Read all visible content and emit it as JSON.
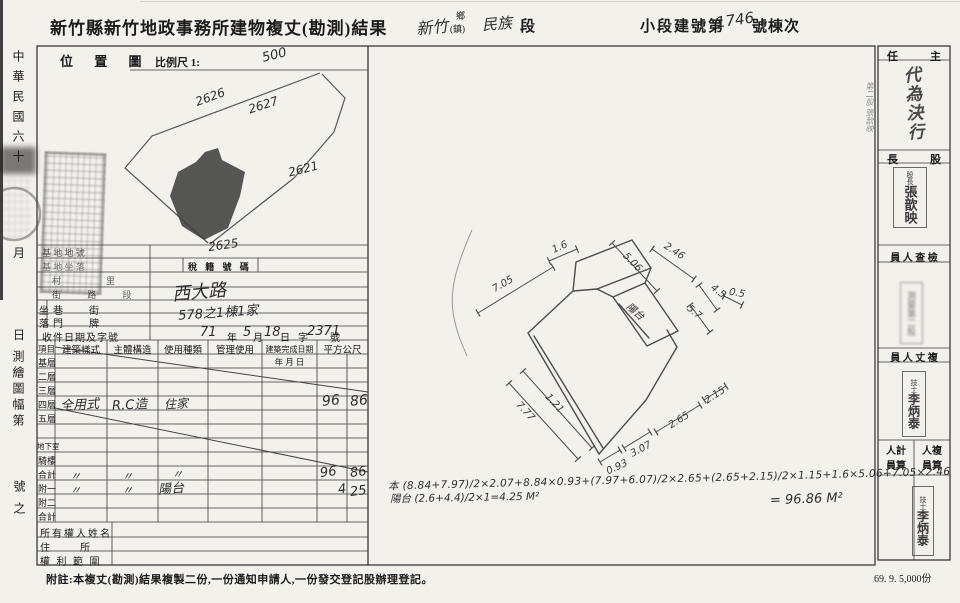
{
  "page": {
    "print_code": "69. 9. 5,000份"
  },
  "header": {
    "office_title": "新竹縣新竹地政事務所建物複丈(勘測)結果",
    "township_value": "新竹",
    "township_unit_top": "鄉",
    "township_unit_bottom": "(鎮)",
    "section_value": "民族",
    "section_unit": "段",
    "building_no_label": "小段建號第",
    "building_no_value": "1746",
    "building_no_suffix": "號棟次"
  },
  "date_strip": {
    "era": "中華民國六十",
    "month_char": "月",
    "day_char": "日",
    "map_sheet": "測繪圖幅第",
    "map_sheet_suffix": "號之"
  },
  "location_map": {
    "title": "位 置 圖",
    "scale_label": "比例尺 1:",
    "scale_value": "500",
    "parcel_2626": "2626",
    "parcel_2627": "2627",
    "parcel_2621": "2621",
    "parcel_2625": "2625"
  },
  "site_info": {
    "row_base_no": "基 地 地 號",
    "row_base_loc": "基 地 坐 落",
    "tax_no_label": "稅 籍 號 碼",
    "row_village": "村　里",
    "row_street": "街 路 段",
    "street_value": "西大路",
    "loc_vertical_top": "坐",
    "loc_vertical_bottom": "落",
    "row_lane": "巷　　街",
    "row_door": "門　　牌",
    "door_value": "578之1棟1家",
    "receipt_label": "收件日期及字號",
    "receipt_year": "71",
    "receipt_year_unit": "年",
    "receipt_month": "5",
    "receipt_month_unit": "月",
    "receipt_day": "18",
    "receipt_day_unit": "日",
    "receipt_char": "字",
    "receipt_no": "2371",
    "receipt_no_unit": "號"
  },
  "building_table": {
    "headers": [
      "項目",
      "建築樣式",
      "主體構造",
      "使用種類",
      "管理使用",
      "建築完成日期",
      "平方公尺"
    ],
    "date_subheader": "年 月 日",
    "row_labels": [
      "基層",
      "二層",
      "三層",
      "四層",
      "五層",
      "地下室",
      "騎樓",
      "合計",
      "附一",
      "附二",
      "合計"
    ],
    "floor4": {
      "style": "全用式",
      "structure": "R.C造",
      "use": "住家",
      "area_int": "96",
      "area_dec": "86"
    },
    "total": {
      "style": "〃",
      "structure": "〃",
      "use": "〃",
      "area_int": "96",
      "area_dec": "86"
    },
    "annex1": {
      "style": "〃",
      "structure": "〃",
      "use": "陽台",
      "area_int": "4",
      "area_dec": "25"
    },
    "owner_label": "所有權人姓名",
    "address_label": "住　　　所",
    "rights_label": "權 利 範 圍"
  },
  "sketch": {
    "dims": [
      "7.05",
      "1.6",
      "5.06",
      "2.46",
      "4.5",
      "5.7",
      "0.5",
      "7.77",
      "1.21",
      "0.93",
      "3.07",
      "2.65",
      "2.15"
    ],
    "balcony_label": "陽台",
    "formula_main": "本 (8.84+7.97)/2×2.07+8.84×0.93+(7.97+6.07)/2×2.65+(2.65+2.15)/2×1.15+1.6×5.06+7.05×2.46",
    "formula_balcony": "陽台 (2.6+4.4)/2×1=4.25 M²",
    "formula_result": "= 96.86 M²"
  },
  "sidebar": {
    "chief_label_right": "主",
    "chief_label_left": "任",
    "chief_stamp": "代為決行",
    "chief_note": "第二股 張歆映",
    "section_chief_right": "股",
    "section_chief_left": "長",
    "section_chief_stamp_title": "股長",
    "section_chief_stamp_name": "張歆映",
    "inspector_label": "員 人 查 檢",
    "inspector_stamp": "測量第二股",
    "surveyor_label": "員 人 丈 複",
    "surveyor_stamp_title": "技士",
    "surveyor_stamp_name": "李炳泰",
    "calc_label_l1": "人計",
    "calc_label_l2": "員算",
    "recheck_label_l1": "人複",
    "recheck_label_l2": "員算",
    "calc_stamp_title": "技士",
    "calc_stamp_name": "李炳泰"
  },
  "footer": {
    "note": "附註:本複丈(勘測)結果複製二份,一份通知申請人,一份發交登記股辦理登記。"
  }
}
